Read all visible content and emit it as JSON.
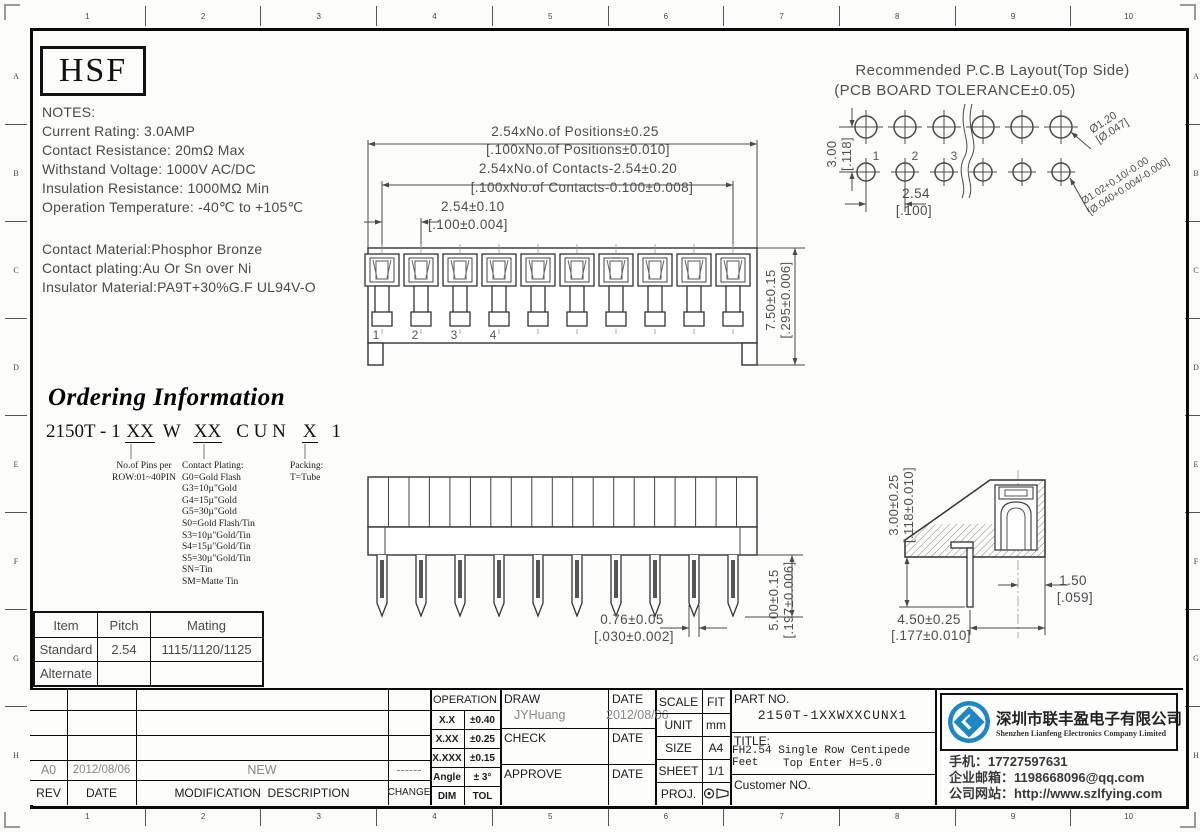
{
  "frame": {
    "top_numbers": [
      "1",
      "2",
      "3",
      "4",
      "5",
      "6",
      "7",
      "8",
      "9",
      "10"
    ],
    "bottom_numbers": [
      "1",
      "2",
      "3",
      "4",
      "5",
      "6",
      "7",
      "8",
      "9",
      "10"
    ],
    "left_letters": [
      "A",
      "B",
      "C",
      "D",
      "E",
      "F",
      "G",
      "H"
    ],
    "right_letters": [
      "A",
      "B",
      "C",
      "D",
      "E",
      "F",
      "G",
      "H"
    ]
  },
  "logo_box": {
    "text": "HSF"
  },
  "notes": {
    "title": "NOTES:",
    "lines": [
      "Current Rating: 3.0AMP",
      "Contact Resistance: 20mΩ Max",
      "Withstand Voltage: 1000V AC/DC",
      "Insulation Resistance: 1000MΩ Min",
      "Operation Temperature: -40℃ to +105℃"
    ]
  },
  "materials": {
    "lines": [
      "Contact Material:Phosphor Bronze",
      "Contact plating:Au Or Sn over Ni",
      "Insulator Material:PA9T+30%G.F UL94V-O"
    ]
  },
  "pcb_layout": {
    "title_line1": "Recommended P.C.B Layout(Top Side)",
    "title_line2": "(PCB BOARD TOLERANCE±0.05)",
    "row_pitch_mm": "3.00",
    "row_pitch_in": "[.118]",
    "col_pitch_mm": "2.54",
    "col_pitch_in": "[.100]",
    "hole_top_mm": "Ø1.20",
    "hole_top_in": "[Ø.047]",
    "hole_bottom_mm": "Ø1.02+0.10/-0.00",
    "hole_bottom_in": "[Ø.040+0.004/-0.000]",
    "pin_labels": [
      "1",
      "2",
      "3"
    ]
  },
  "top_view": {
    "dim_positions_mm": "2.54xNo.of Positions±0.25",
    "dim_positions_in": "[.100xNo.of Positions±0.010]",
    "dim_contacts_mm": "2.54xNo.of Contacts-2.54±0.20",
    "dim_contacts_in": "[.100xNo.of Contacts-0.100±0.008]",
    "dim_pitch_mm": "2.54±0.10",
    "dim_pitch_in": "[.100±0.004]",
    "dim_height_mm": "7.50±0.15",
    "dim_height_in": "[.295±0.006]",
    "pin_numbers": [
      "1",
      "2",
      "3",
      "4"
    ]
  },
  "front_view": {
    "dim_tail_mm": "0.76±0.05",
    "dim_tail_in": "[.030±0.002]",
    "dim_pin_len_mm": "5.00±0.15",
    "dim_pin_len_in": "[.197±0.006]"
  },
  "side_view": {
    "dim_height_mm": "3.00±0.25",
    "dim_height_in": "[.118±0.010]",
    "dim_depth_mm": "4.50±0.25",
    "dim_depth_in": "[.177±0.010]",
    "dim_offset_mm": "1.50",
    "dim_offset_in": "[.059]"
  },
  "ordering": {
    "title": "Ordering Information",
    "code_prefix": "2150T - 1",
    "code_pins": "XX",
    "code_mid": "W",
    "code_plating": "XX",
    "code_series": "C U N",
    "code_packing": "X",
    "code_suffix": "1",
    "pins_note_line1": "No.of Pins per",
    "pins_note_line2": "ROW:01~40PIN",
    "plating_title": "Contact Plating:",
    "plating_options": [
      "G0=Gold Flash",
      "G3=10µ\"Gold",
      "G4=15µ\"Gold",
      "G5=30µ\"Gold",
      "S0=Gold Flash/Tin",
      "S3=10µ\"Gold/Tin",
      "S4=15µ\"Gold/Tin",
      "S5=30µ\"Gold/Tin",
      "SN=Tin",
      "SM=Matte Tin"
    ],
    "packing_title": "Packing:",
    "packing_option": "T=Tube"
  },
  "mating_table": {
    "headers": [
      "Item",
      "Pitch",
      "Mating"
    ],
    "rows": [
      [
        "Standard",
        "2.54",
        "1115/1120/1125"
      ],
      [
        "Alternate",
        "",
        ""
      ]
    ]
  },
  "revision": {
    "row": {
      "rev": "A0",
      "date": "2012/08/06",
      "desc": "NEW",
      "change": "------"
    },
    "headers": {
      "rev": "REV",
      "date": "DATE",
      "desc": "MODIFICATION  DESCRIPTION",
      "change": "CHANGE"
    }
  },
  "tolerances": {
    "title": "OPERATION",
    "rows": [
      {
        "l": "X.X",
        "v": "±0.40"
      },
      {
        "l": "X.XX",
        "v": "±0.25"
      },
      {
        "l": "X.XXX",
        "v": "±0.15"
      },
      {
        "l": "Angle",
        "v": "± 3°"
      },
      {
        "l": "DIM",
        "v": "TOL"
      }
    ]
  },
  "approvals": {
    "draw_label": "DRAW",
    "draw_date_label": "DATE",
    "draw_name": "JYHuang",
    "draw_date": "2012/08/06",
    "check_label": "CHECK",
    "check_date_label": "DATE",
    "approve_label": "APPROVE",
    "approve_date_label": "DATE"
  },
  "doc_info": {
    "scale_label": "SCALE",
    "scale_value": "FIT",
    "unit_label": "UNIT",
    "unit_value": "mm",
    "size_label": "SIZE",
    "size_value": "A4",
    "sheet_label": "SHEET",
    "sheet_value": "1/1",
    "proj_label": "PROJ."
  },
  "part_info": {
    "part_no_label": "PART NO.",
    "part_no": "2150T-1XXWXXCUNX1",
    "title_label": "TITLE:",
    "title_line1": "FH2.54 Single Row Centipede Feet",
    "title_line2": "Top Enter H=5.0",
    "customer_label": "Customer NO."
  },
  "company": {
    "name_cn": "深圳市联丰盈电子有限公司",
    "name_en": "Shenzhen Lianfeng Electronics Company Limited",
    "phone": "手机：17727597631",
    "email": "企业邮箱：1198668096@qq.com",
    "website": "公司网站：http://www.szlfying.com"
  },
  "colors": {
    "brand_blue": "#1d87c6",
    "line": "#3c3c3c"
  }
}
